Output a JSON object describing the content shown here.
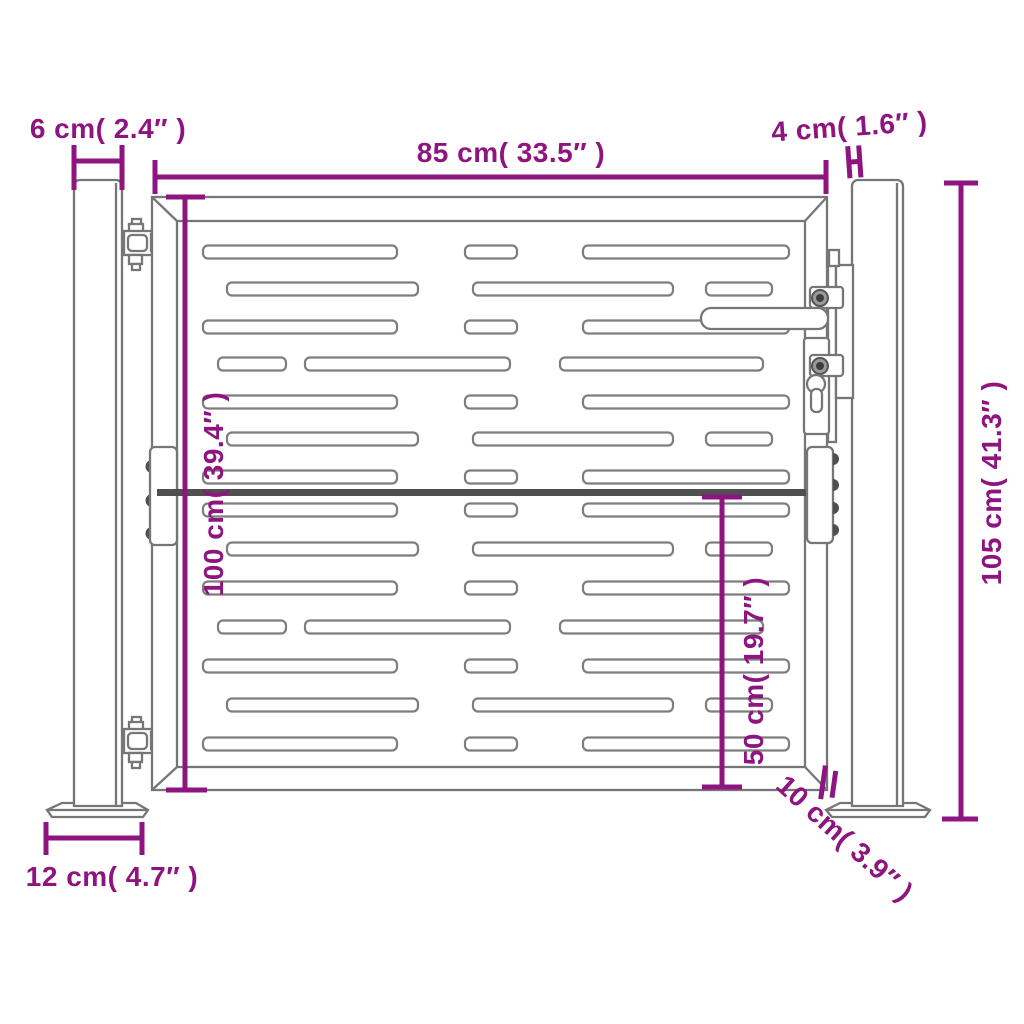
{
  "page": {
    "background": "#ffffff"
  },
  "colors": {
    "accent": "#8e1480",
    "line": "#767676",
    "dark": "#4f4f4f"
  },
  "diagram": {
    "type": "product-dimension-diagram",
    "subject": "steel garden gate with two square posts, slotted panel, hinges and lock",
    "dimensions": {
      "post_width": "6 cm( 2.4″ )",
      "gate_width": "85 cm( 33.5″ )",
      "gate_to_post_gap": "4 cm( 1.6″ )",
      "post_height": "105 cm( 41.3″ )",
      "gate_height": "100 cm( 39.4″ )",
      "lower_half_height": "50 cm( 19.7″ )",
      "ground_clearance": "10 cm( 3.9″ )",
      "base_plate_width": "12 cm( 4.7″ )"
    }
  }
}
